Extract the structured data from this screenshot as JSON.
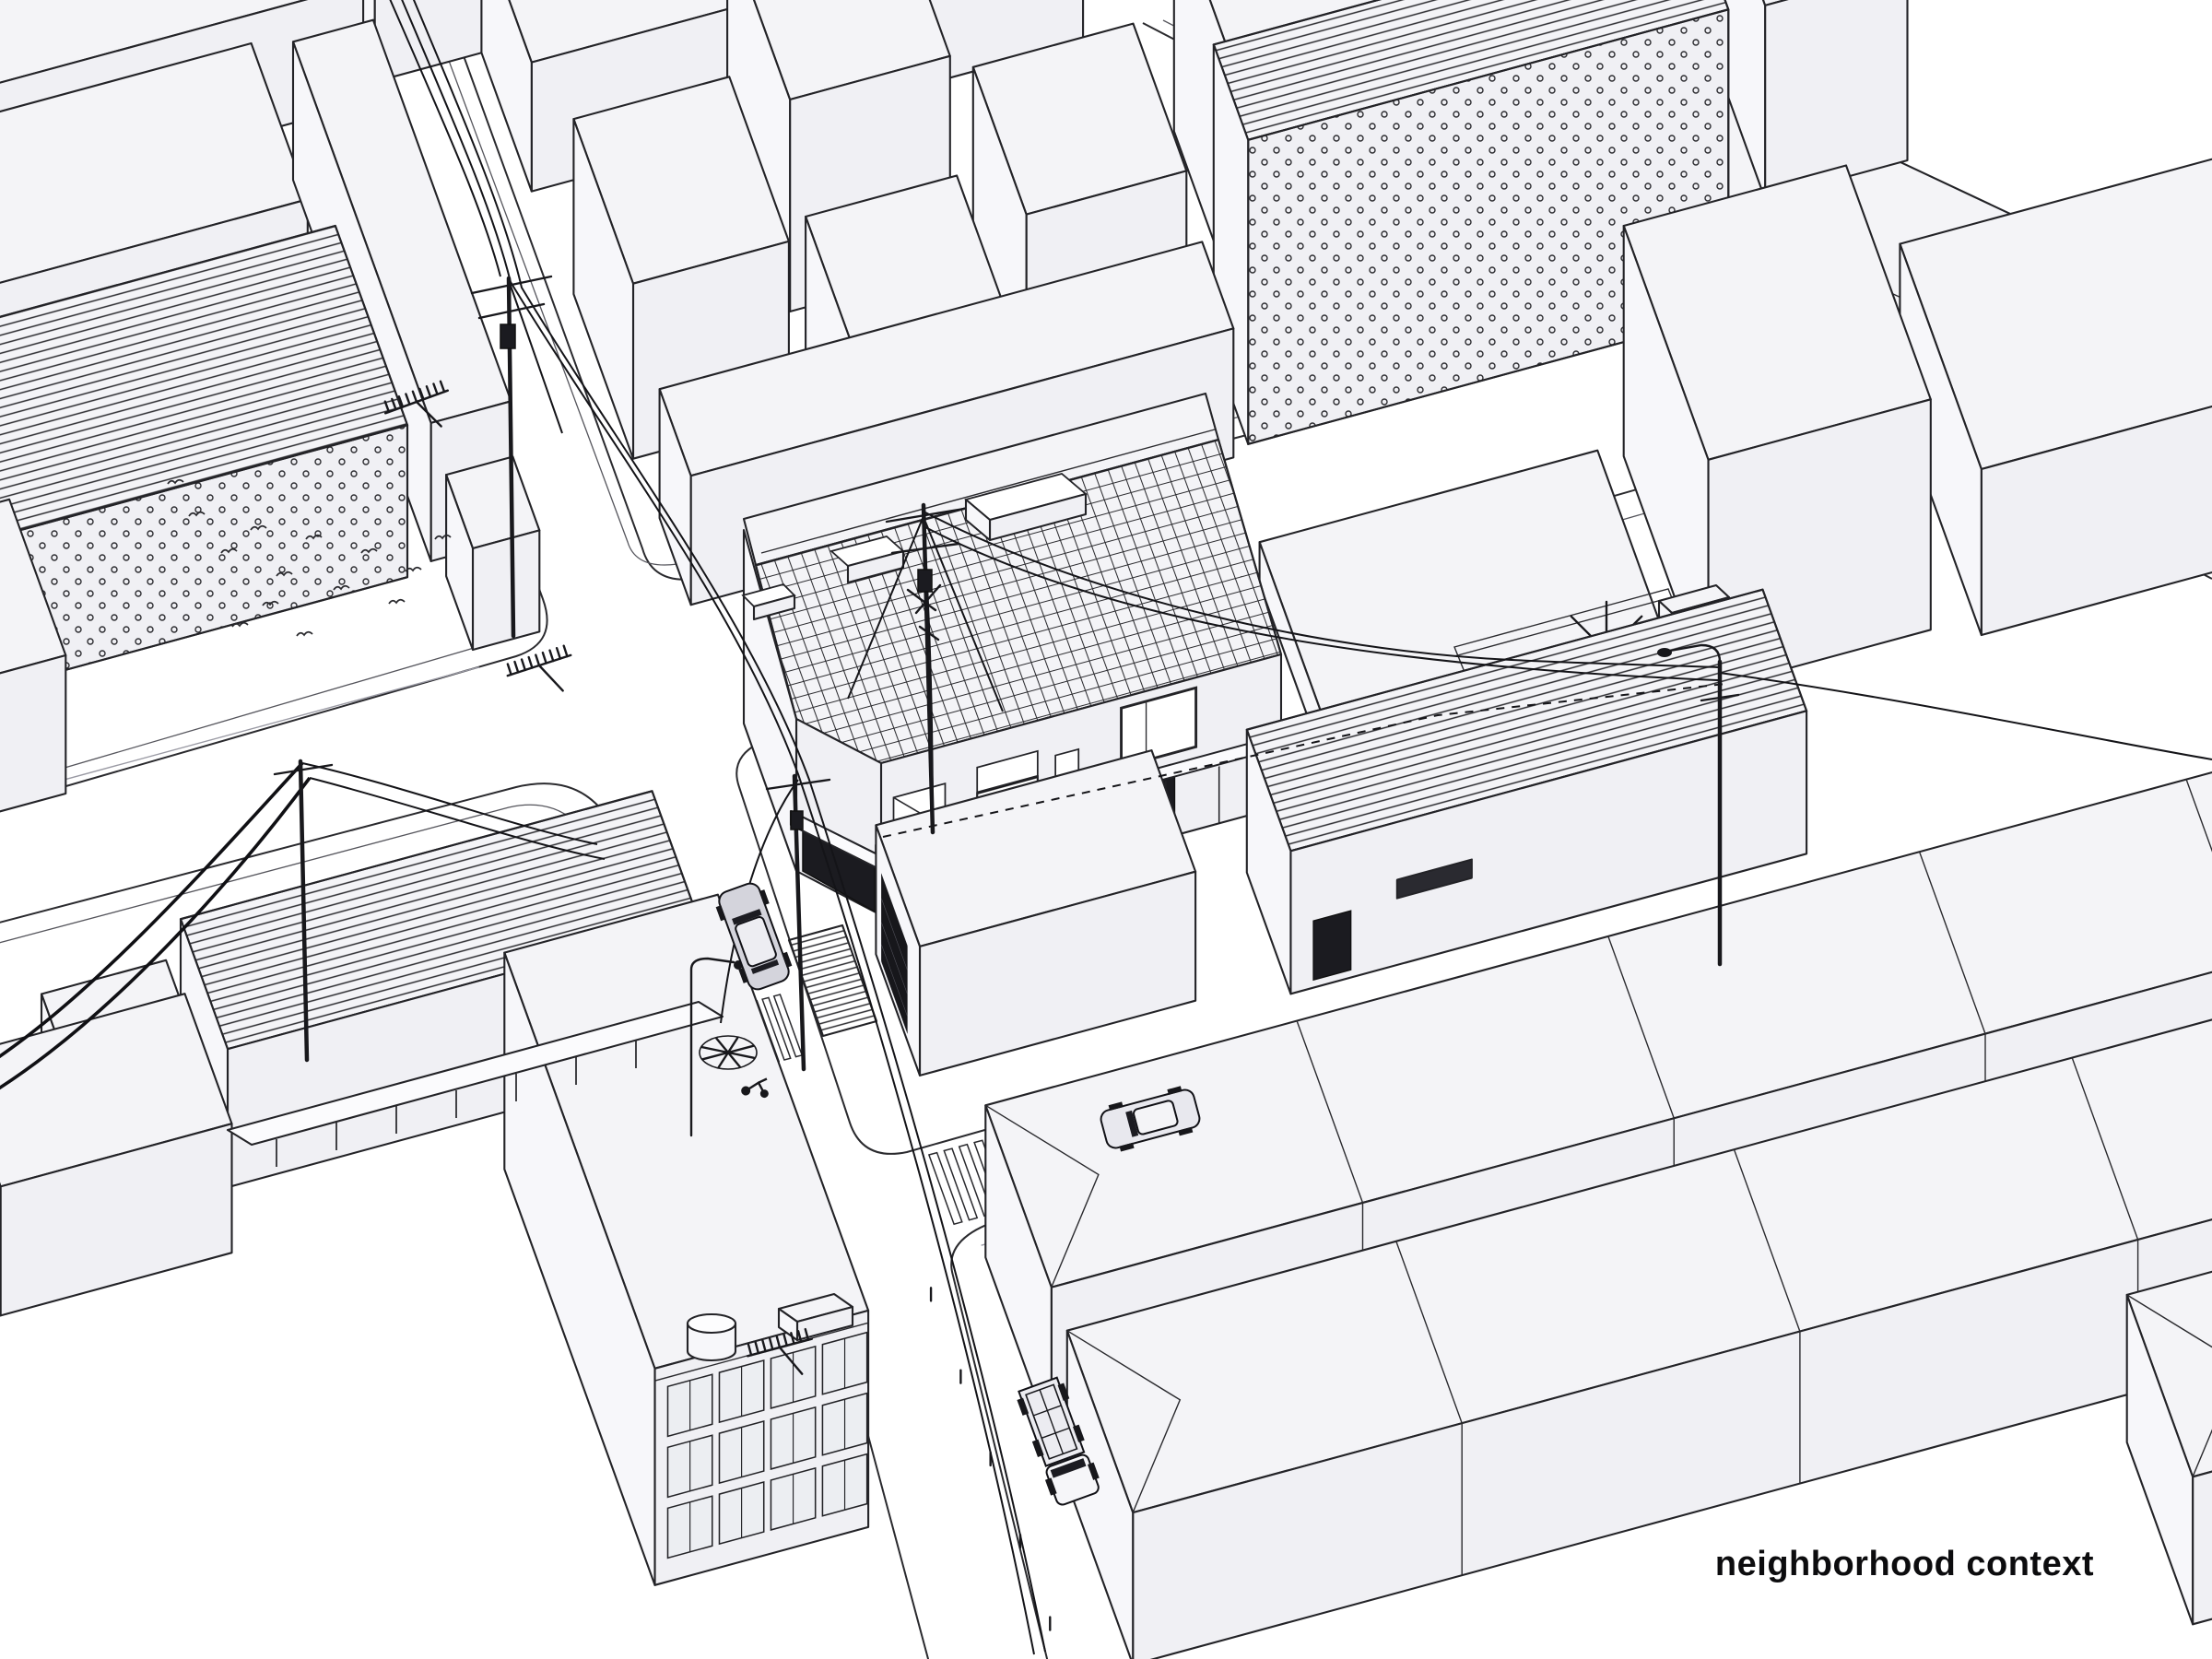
{
  "caption": {
    "text": "neighborhood context"
  },
  "palette": {
    "background": "#ffffff",
    "line": "#232327",
    "building_mass": "#f3f3f6",
    "dark_detail": "#1b1b20"
  },
  "scene": {
    "subject": "axonometric neighborhood drawing",
    "features": [
      "street intersection",
      "corner house with tiled roof and skylights",
      "dotted facade buildings",
      "corrugated roofs",
      "utility poles and power lines",
      "crosswalks",
      "cars and truck",
      "apartment block with window grid",
      "terrace with tree"
    ]
  }
}
